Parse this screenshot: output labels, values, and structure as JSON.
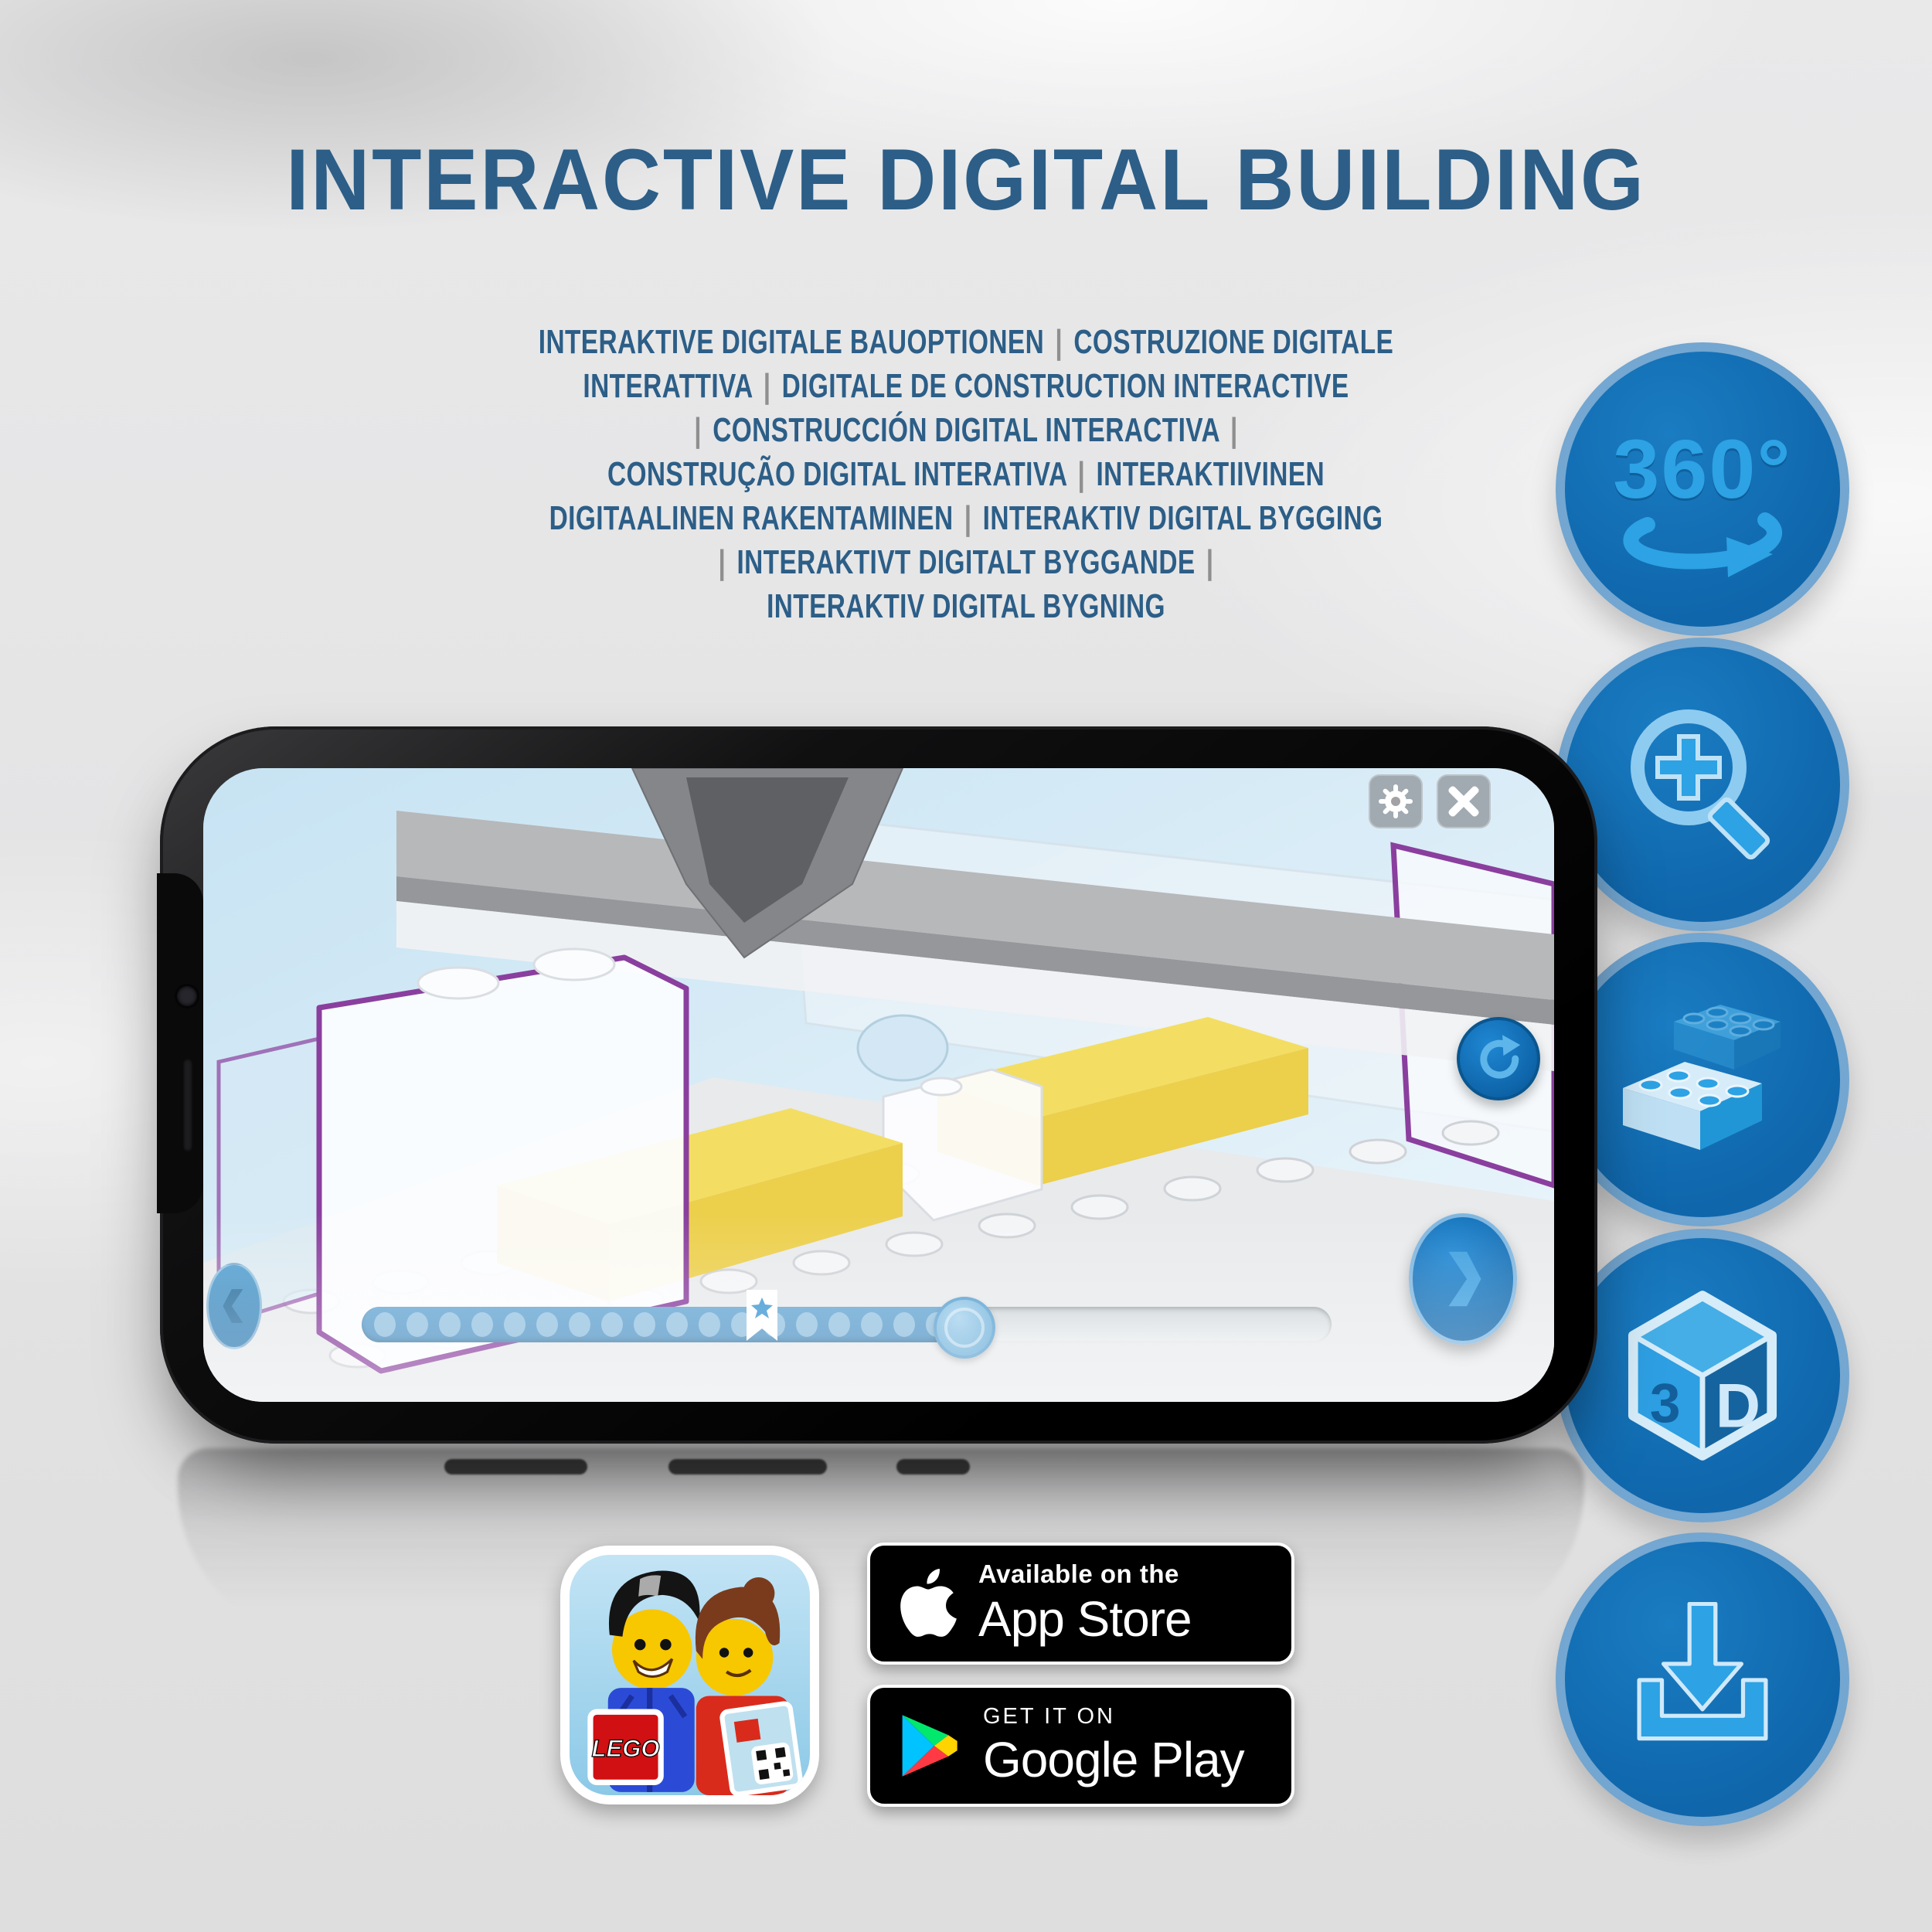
{
  "title": "INTERACTIVE DIGITAL BUILDING",
  "subtitle_lines": [
    "INTERAKTIVE DIGITALE BAUOPTIONEN | COSTRUZIONE DIGITALE",
    "INTERATTIVA | DIGITALE DE CONSTRUCTION INTERACTIVE",
    "| CONSTRUCCIÓN DIGITAL INTERACTIVA |",
    "CONSTRUÇÃO DIGITAL INTERATIVA | INTERAKTIIVINEN",
    "DIGITAALINEN RAKENTAMINEN | INTERAKTIV DIGITAL BYGGING",
    "| INTERAKTIVT DIGITALT BYGGANDE |",
    "INTERAKTIV DIGITAL BYGNING"
  ],
  "features": [
    {
      "name": "360-rotation",
      "label": "360°"
    },
    {
      "name": "zoom-in"
    },
    {
      "name": "brick-building"
    },
    {
      "name": "3d-view",
      "cube_left": "3",
      "cube_right": "D"
    },
    {
      "name": "download"
    }
  ],
  "store_badges": {
    "app_store": {
      "tagline": "Available on the",
      "store_name": "App Store"
    },
    "google_play": {
      "tagline": "GET IT ON",
      "store_name": "Google Play"
    }
  },
  "app_icon": {
    "logo_text": "LEGO"
  },
  "slider": {
    "dots_total": 18
  },
  "colors": {
    "headline": "#2c5e87",
    "separator": "#8f8f8f",
    "circle_fill": "#0f66ab",
    "circle_ring": "#7eadd4",
    "icon_glyph": "#2da2e4",
    "screen_sky": "#cde6f4",
    "brick_yellow": "#f3de63",
    "outline_purple": "#8a3f9e"
  }
}
